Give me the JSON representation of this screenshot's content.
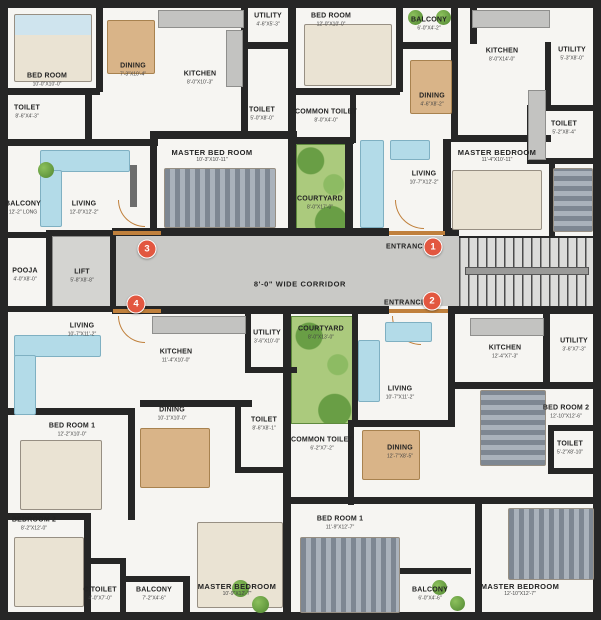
{
  "title": "Cluster floor plan",
  "colors": {
    "wall": "#262626",
    "corridor_floor": "#c9c9c6",
    "courtyard_green": "#abca7d",
    "marker_red": "#e25740",
    "furniture_blue": "#b3dbe8",
    "wood_tan": "#d9b488",
    "door_orange": "#c0803c"
  },
  "plan": {
    "corridor_label": "8'-0\" WIDE CORRIDOR",
    "entrance_label": "ENTRANCE",
    "markers": [
      "1",
      "2",
      "3",
      "4"
    ]
  },
  "rooms": [
    {
      "name": "BED ROOM",
      "dims": "10'-0\"X10'-0\""
    },
    {
      "name": "TOILET",
      "dims": "8'-6\"X4'-3\""
    },
    {
      "name": "DINING",
      "dims": "7'-3\"X10'-4\""
    },
    {
      "name": "KITCHEN",
      "dims": "8'-0\"X10'-3\""
    },
    {
      "name": "UTILITY",
      "dims": "4'-6\"X5'-3\""
    },
    {
      "name": "TOILET",
      "dims": "5'-0\"X8'-0\""
    },
    {
      "name": "MASTER BED ROOM",
      "dims": "10'-3\"X10'-11\""
    },
    {
      "name": "BALCONY",
      "dims": "12'-2\" LONG"
    },
    {
      "name": "LIVING",
      "dims": "12'-0\"X12'-2\""
    },
    {
      "name": "POOJA",
      "dims": "4'-0\"X8'-0\""
    },
    {
      "name": "LIFT",
      "dims": "5'-8\"X8'-8\""
    },
    {
      "name": "BED ROOM",
      "dims": "12'-0\"X10'-0\""
    },
    {
      "name": "BALCONY",
      "dims": "6'-0\"X4'-2\""
    },
    {
      "name": "DINING",
      "dims": "4'-6\"X8'-2\""
    },
    {
      "name": "COMMON TOILET",
      "dims": "8'-0\"X4'-0\""
    },
    {
      "name": "COURTYARD",
      "dims": "8'-0\"X17'-0\""
    },
    {
      "name": "LIVING",
      "dims": "10'-7\"X12'-2\""
    },
    {
      "name": "KITCHEN",
      "dims": "8'-0\"X14'-0\""
    },
    {
      "name": "UTILITY",
      "dims": "5'-3\"X8'-0\""
    },
    {
      "name": "TOILET",
      "dims": "5'-2\"X8'-4\""
    },
    {
      "name": "MASTER BEDROOM",
      "dims": "11'-4\"X10'-11\""
    },
    {
      "name": "LIVING",
      "dims": "10'-7\"X11'-2\""
    },
    {
      "name": "KITCHEN",
      "dims": "11'-4\"X10'-0\""
    },
    {
      "name": "UTILITY",
      "dims": "3'-6\"X10'-0\""
    },
    {
      "name": "DINING",
      "dims": "10'-1\"X10'-0\""
    },
    {
      "name": "TOILET",
      "dims": "8'-6\"X8'-1\""
    },
    {
      "name": "BED ROOM 1",
      "dims": "12'-2\"X10'-0\""
    },
    {
      "name": "BEDROOM 2",
      "dims": "8'-2\"X12'-0\""
    },
    {
      "name": "C.TOILET",
      "dims": "4'-0\"X7'-0\""
    },
    {
      "name": "BALCONY",
      "dims": "7'-2\"X4'-6\""
    },
    {
      "name": "COURTYARD",
      "dims": "8'-0\"X13'-0\""
    },
    {
      "name": "LIVING",
      "dims": "10'-7\"X11'-2\""
    },
    {
      "name": "COMMON TOILET",
      "dims": "6'-2\"X7'-2\""
    },
    {
      "name": "DINING",
      "dims": "12'-7\"X8'-5\""
    },
    {
      "name": "BED ROOM 1",
      "dims": "11'-9\"X12'-7\""
    },
    {
      "name": "MASTER BEDROOM",
      "dims": "10'-9\"X12'-7\""
    },
    {
      "name": "KITCHEN",
      "dims": "12'-4\"X7'-3\""
    },
    {
      "name": "UTILITY",
      "dims": "3'-6\"X7'-3\""
    },
    {
      "name": "BED ROOM 2",
      "dims": "12'-10\"X12'-6\""
    },
    {
      "name": "TOILET",
      "dims": "5'-2\"X8'-10\""
    },
    {
      "name": "MASTER BEDROOM",
      "dims": "12'-10\"X12'-7\""
    },
    {
      "name": "BALCONY",
      "dims": "6'-0\"X4'-6\""
    }
  ]
}
